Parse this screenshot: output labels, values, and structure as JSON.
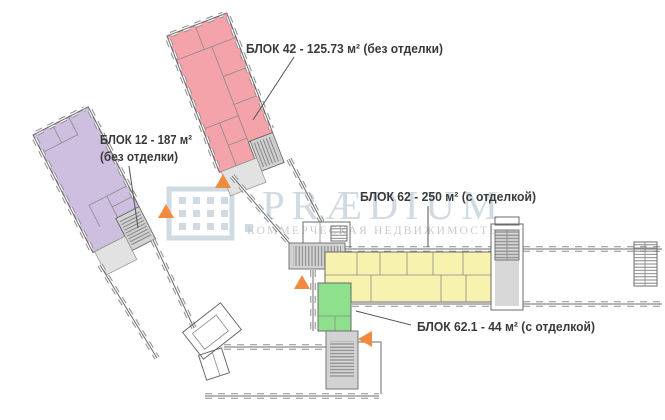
{
  "plan": {
    "label_color": "#3a3a3a",
    "wall_color": "#6b6b6b",
    "marker_color": "#ef8a3e",
    "blocks": [
      {
        "id": "blok-42",
        "label": "БЛОК 42 - 125.73 м² (без отделки)",
        "color": "#f5a3ab"
      },
      {
        "id": "blok-12",
        "label_line1": "БЛОК 12 - 187 м²",
        "label_line2": "(без отделки)",
        "color": "#cebee0"
      },
      {
        "id": "blok-62",
        "label": "БЛОК 62 - 250 м² (с отделкой)",
        "color": "#f8f2af"
      },
      {
        "id": "blok-62-1",
        "label": "БЛОК 62.1 - 44 м² (с отделкой)",
        "color": "#8ee08d"
      }
    ]
  },
  "watermark": {
    "brand": "PRÆDIUM",
    "tagline": "КОММЕРЧЕСКАЯ НЕДВИЖИМОСТЬ",
    "primary_color": "#cfdae3",
    "tagline_color": "#c7ccd1"
  }
}
